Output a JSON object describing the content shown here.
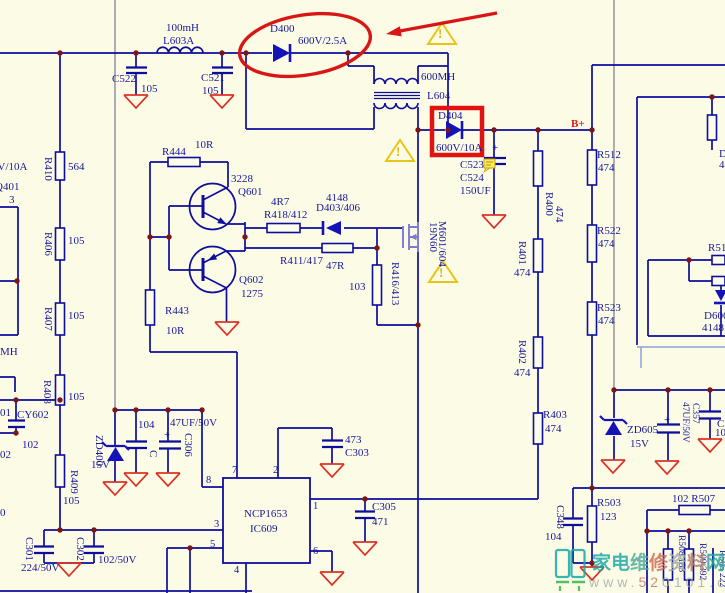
{
  "colors": {
    "background": "#fcfce6",
    "wire_blue": "#0d0d9e",
    "text_blue": "#17179a",
    "net_gray": "#a4a4ac",
    "junction_dot": "#7c1616",
    "annotation_red": "#d81616",
    "ground_red": "#dd3326",
    "warning_yellow": "#e8c414",
    "mosfet_blue": "#7b7bd2",
    "watermark_teal": "#17a8a8"
  },
  "labels": [
    {
      "id": "l603a-value",
      "text": "100mH",
      "x": 166,
      "y": 23
    },
    {
      "id": "l603a-ref",
      "text": "L603A",
      "x": 163,
      "y": 36
    },
    {
      "id": "c522-ref",
      "text": "C522",
      "x": 112,
      "y": 74
    },
    {
      "id": "c522-value",
      "text": "105",
      "x": 141,
      "y": 84
    },
    {
      "id": "c521-ref",
      "text": "C521",
      "x": 201,
      "y": 73
    },
    {
      "id": "c521-value",
      "text": "105",
      "x": 202,
      "y": 86
    },
    {
      "id": "d400-ref",
      "text": "D400",
      "x": 270,
      "y": 24
    },
    {
      "id": "d400-value",
      "text": "600V/2.5A",
      "x": 298,
      "y": 36
    },
    {
      "id": "xfmr-value",
      "text": "600MH",
      "x": 421,
      "y": 72
    },
    {
      "id": "xfmr-ref",
      "text": "L604",
      "x": 427,
      "y": 91
    },
    {
      "id": "d404-ref",
      "text": "D404",
      "x": 438,
      "y": 111
    },
    {
      "id": "d404-value",
      "text": "600V/10A",
      "x": 436,
      "y": 143
    },
    {
      "id": "bplus-net",
      "text": "B+",
      "x": 571,
      "y": 119,
      "cls": "red"
    },
    {
      "id": "c523-ref",
      "text": "C523",
      "x": 460,
      "y": 160
    },
    {
      "id": "c524-ref",
      "text": "C524",
      "x": 460,
      "y": 173
    },
    {
      "id": "c524-value",
      "text": "150UF",
      "x": 460,
      "y": 186
    },
    {
      "id": "c523-plus",
      "text": "+",
      "x": 492,
      "y": 143
    },
    {
      "id": "warning-1",
      "text": "!",
      "x": 438,
      "y": 27,
      "cls": "warn"
    },
    {
      "id": "warning-2",
      "text": "!",
      "x": 396,
      "y": 145,
      "cls": "warn"
    },
    {
      "id": "warning-3",
      "text": "!",
      "x": 439,
      "y": 266,
      "cls": "warn"
    },
    {
      "id": "r512-ref",
      "text": "R512",
      "x": 597,
      "y": 150
    },
    {
      "id": "r512-value",
      "text": "474",
      "x": 598,
      "y": 163
    },
    {
      "id": "r522-ref",
      "text": "R522",
      "x": 597,
      "y": 226
    },
    {
      "id": "r522-value",
      "text": "474",
      "x": 598,
      "y": 239
    },
    {
      "id": "r523-ref",
      "text": "R523",
      "x": 597,
      "y": 303
    },
    {
      "id": "r523-value",
      "text": "474",
      "x": 598,
      "y": 316
    },
    {
      "id": "r400-ref",
      "text": "R400",
      "x": 554,
      "y": 192,
      "cls": "rot"
    },
    {
      "id": "r400-value",
      "text": "474",
      "x": 564,
      "y": 206,
      "cls": "rot"
    },
    {
      "id": "r401-ref",
      "text": "R401",
      "x": 527,
      "y": 241,
      "cls": "rot"
    },
    {
      "id": "r401-value",
      "text": "474",
      "x": 514,
      "y": 268
    },
    {
      "id": "r402-ref",
      "text": "R402",
      "x": 527,
      "y": 340,
      "cls": "rot"
    },
    {
      "id": "r402-value",
      "text": "474",
      "x": 514,
      "y": 368
    },
    {
      "id": "r403-ref",
      "text": "R403",
      "x": 543,
      "y": 410
    },
    {
      "id": "r403-value",
      "text": "474",
      "x": 545,
      "y": 424
    },
    {
      "id": "mosfet-part",
      "text": "19N60",
      "x": 438,
      "y": 222,
      "cls": "rot"
    },
    {
      "id": "mosfet-ref",
      "text": "M601/604",
      "x": 447,
      "y": 221,
      "cls": "rot"
    },
    {
      "id": "r444-value",
      "text": "10R",
      "x": 195,
      "y": 140
    },
    {
      "id": "r444-ref",
      "text": "R444",
      "x": 162,
      "y": 147
    },
    {
      "id": "q601-part",
      "text": "3228",
      "x": 231,
      "y": 174
    },
    {
      "id": "q601-ref",
      "text": "Q601",
      "x": 238,
      "y": 187
    },
    {
      "id": "q602-ref",
      "text": "Q602",
      "x": 239,
      "y": 275
    },
    {
      "id": "q602-part",
      "text": "1275",
      "x": 241,
      "y": 289
    },
    {
      "id": "r443-ref",
      "text": "R443",
      "x": 165,
      "y": 306
    },
    {
      "id": "r443-value",
      "text": "10R",
      "x": 166,
      "y": 326
    },
    {
      "id": "r418-value",
      "text": "4R7",
      "x": 271,
      "y": 197
    },
    {
      "id": "r418-ref",
      "text": "R418/412",
      "x": 264,
      "y": 210
    },
    {
      "id": "d403-part",
      "text": "4148",
      "x": 326,
      "y": 193
    },
    {
      "id": "d403-ref",
      "text": "D403/406",
      "x": 316,
      "y": 203
    },
    {
      "id": "r411-ref",
      "text": "R411/417",
      "x": 280,
      "y": 256
    },
    {
      "id": "r411-value",
      "text": "47R",
      "x": 326,
      "y": 261
    },
    {
      "id": "r416-value",
      "text": "103",
      "x": 349,
      "y": 282
    },
    {
      "id": "r416-ref",
      "text": "R416/413",
      "x": 400,
      "y": 262,
      "cls": "rot"
    },
    {
      "id": "r410-ref",
      "text": "R410",
      "x": 53,
      "y": 157,
      "cls": "rot"
    },
    {
      "id": "r410-value",
      "text": "564",
      "x": 68,
      "y": 162
    },
    {
      "id": "r406-ref",
      "text": "R406",
      "x": 53,
      "y": 232,
      "cls": "rot"
    },
    {
      "id": "r406-value",
      "text": "105",
      "x": 68,
      "y": 236
    },
    {
      "id": "r407-ref",
      "text": "R407",
      "x": 53,
      "y": 307,
      "cls": "rot"
    },
    {
      "id": "r407-value",
      "text": "105",
      "x": 68,
      "y": 311
    },
    {
      "id": "r408-ref",
      "text": "R408",
      "x": 52,
      "y": 380,
      "cls": "rot"
    },
    {
      "id": "r408-value",
      "text": "105",
      "x": 68,
      "y": 392
    },
    {
      "id": "r409-ref",
      "text": "R409",
      "x": 79,
      "y": 470,
      "cls": "rot"
    },
    {
      "id": "r409-value",
      "text": "105",
      "x": 63,
      "y": 496
    },
    {
      "id": "edge-600v10a",
      "text": "600V/10A",
      "x": -19,
      "y": 162
    },
    {
      "id": "edge-q401",
      "text": "Q401",
      "x": -5,
      "y": 182
    },
    {
      "id": "edge-pin3",
      "text": "3",
      "x": 9,
      "y": 195
    },
    {
      "id": "edge-mh",
      "text": "MH",
      "x": 0,
      "y": 347
    },
    {
      "id": "edge-01",
      "text": "01",
      "x": 0,
      "y": 408
    },
    {
      "id": "cy602-value",
      "text": "102",
      "x": 22,
      "y": 440
    },
    {
      "id": "edge-02",
      "text": "02",
      "x": 0,
      "y": 450
    },
    {
      "id": "edge-0",
      "text": "0",
      "x": 0,
      "y": 508
    },
    {
      "id": "cy602-ref",
      "text": "CY602",
      "x": 17,
      "y": 410
    },
    {
      "id": "zd400-ref",
      "text": "ZD400",
      "x": 104,
      "y": 435,
      "cls": "rot"
    },
    {
      "id": "zd400-value",
      "text": "15V",
      "x": 91,
      "y": 460
    },
    {
      "id": "c-unk-value",
      "text": "104",
      "x": 138,
      "y": 420
    },
    {
      "id": "c-unk-ref",
      "text": "C",
      "x": 158,
      "y": 450,
      "cls": "rot"
    },
    {
      "id": "c306-value",
      "text": "47UF/50V",
      "x": 170,
      "y": 418
    },
    {
      "id": "c306-ref",
      "text": "C306",
      "x": 193,
      "y": 433,
      "cls": "rot"
    },
    {
      "id": "c306-plus",
      "text": "+",
      "x": 164,
      "y": 430
    },
    {
      "id": "c301-ref",
      "text": "C301",
      "x": 34,
      "y": 537,
      "cls": "rot"
    },
    {
      "id": "c301-value",
      "text": "224/50V",
      "x": 21,
      "y": 563
    },
    {
      "id": "c302-ref",
      "text": "C302",
      "x": 85,
      "y": 537,
      "cls": "rot"
    },
    {
      "id": "c302-value",
      "text": "102/50V",
      "x": 98,
      "y": 555
    },
    {
      "id": "ic-part",
      "text": "NCP1653",
      "x": 244,
      "y": 509
    },
    {
      "id": "ic-ref",
      "text": "IC609",
      "x": 250,
      "y": 524
    },
    {
      "id": "ic-pin7",
      "text": "7",
      "x": 232,
      "y": 466,
      "cls": "pin"
    },
    {
      "id": "ic-pin2",
      "text": "2",
      "x": 273,
      "y": 466,
      "cls": "pin"
    },
    {
      "id": "ic-pin8",
      "text": "8",
      "x": 206,
      "y": 476,
      "cls": "pin"
    },
    {
      "id": "ic-pin3",
      "text": "3",
      "x": 214,
      "y": 520,
      "cls": "pin"
    },
    {
      "id": "ic-pin5",
      "text": "5",
      "x": 210,
      "y": 540,
      "cls": "pin"
    },
    {
      "id": "ic-pin1",
      "text": "1",
      "x": 313,
      "y": 502,
      "cls": "pin"
    },
    {
      "id": "ic-pin6",
      "text": "6",
      "x": 313,
      "y": 547,
      "cls": "pin"
    },
    {
      "id": "ic-pin4",
      "text": "4",
      "x": 234,
      "y": 566,
      "cls": "pin"
    },
    {
      "id": "c303-value",
      "text": "473",
      "x": 345,
      "y": 435
    },
    {
      "id": "c303-ref",
      "text": "C303",
      "x": 345,
      "y": 448
    },
    {
      "id": "c305-ref",
      "text": "C305",
      "x": 372,
      "y": 502
    },
    {
      "id": "c305-value",
      "text": "471",
      "x": 372,
      "y": 517
    },
    {
      "id": "c348-ref",
      "text": "C348",
      "x": 565,
      "y": 505,
      "cls": "rot"
    },
    {
      "id": "c348-value",
      "text": "104",
      "x": 545,
      "y": 532
    },
    {
      "id": "r503-ref",
      "text": "R503",
      "x": 597,
      "y": 498
    },
    {
      "id": "r503-value",
      "text": "123",
      "x": 600,
      "y": 512
    },
    {
      "id": "zd605-ref",
      "text": "ZD605",
      "x": 627,
      "y": 425
    },
    {
      "id": "zd605-value",
      "text": "15V",
      "x": 630,
      "y": 439
    },
    {
      "id": "c357-plus",
      "text": "+",
      "x": 664,
      "y": 415
    },
    {
      "id": "c357-value",
      "text": "47UF/50V",
      "x": 689,
      "y": 402,
      "cls": "rot small"
    },
    {
      "id": "c357-ref",
      "text": "C357",
      "x": 699,
      "y": 403,
      "cls": "rot small"
    },
    {
      "id": "c-edge-ref",
      "text": "C3",
      "x": 717,
      "y": 419
    },
    {
      "id": "c-edge-value",
      "text": "10",
      "x": 715,
      "y": 428
    },
    {
      "id": "r507-label",
      "text": "102  R507",
      "x": 672,
      "y": 494
    },
    {
      "id": "r508-label",
      "text": "R508  183",
      "x": 685,
      "y": 535,
      "cls": "rot small"
    },
    {
      "id": "r509-label",
      "text": "R509  392",
      "x": 706,
      "y": 543,
      "cls": "rot small"
    },
    {
      "id": "r505-label",
      "text": "R505 222",
      "x": 726,
      "y": 550,
      "cls": "rot small"
    },
    {
      "id": "r51-fragment",
      "text": "R51",
      "x": 708,
      "y": 243
    },
    {
      "id": "d606-ref",
      "text": "D606",
      "x": 704,
      "y": 311
    },
    {
      "id": "d606-value",
      "text": "4148",
      "x": 702,
      "y": 323
    },
    {
      "id": "edge-frag-d",
      "text": "D",
      "x": 719,
      "y": 149
    },
    {
      "id": "edge-frag-4",
      "text": "4",
      "x": 719,
      "y": 160
    }
  ],
  "watermark": {
    "site_name_chars": [
      {
        "ch": "家",
        "color": "#18a6a6"
      },
      {
        "ch": "电",
        "color": "#18a6a6"
      },
      {
        "ch": "维",
        "color": "#4aa898"
      },
      {
        "ch": "修",
        "color": "#cc6a55"
      },
      {
        "ch": "资",
        "color": "#a0aaa2"
      },
      {
        "ch": "料",
        "color": "#b07a6a"
      },
      {
        "ch": "网",
        "color": "#20a49e"
      }
    ],
    "url_segments": [
      {
        "text": "www.",
        "color": "#a6aea8"
      },
      {
        "text": "52",
        "color": "#c97a62"
      },
      {
        "text": "0101",
        "color": "#a6aea8"
      },
      {
        "text": ".c0m",
        "color": "#a6aea8"
      }
    ]
  }
}
